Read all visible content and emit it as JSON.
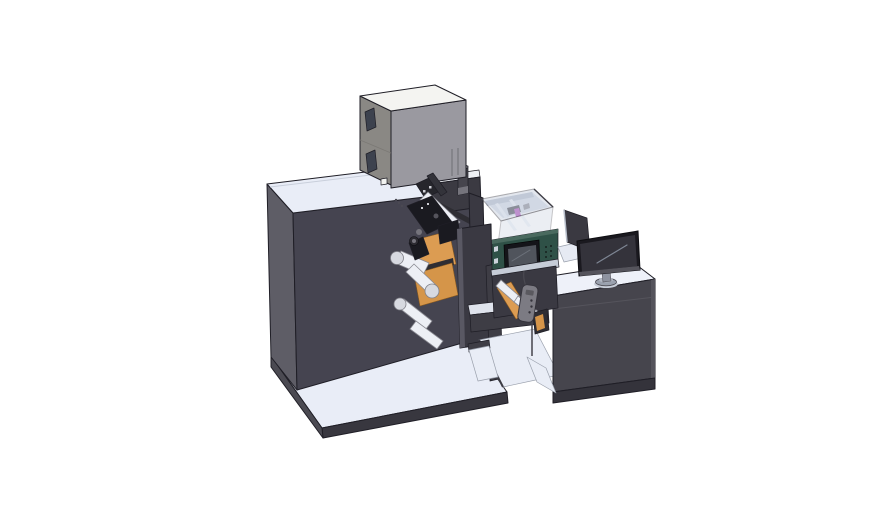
{
  "scene": {
    "type": "3d-cad-render",
    "subject": "label-printing-machine-assembly",
    "parts": [
      "base-platform",
      "main-cabinet",
      "electrical-box",
      "signal-cylinder",
      "unwind-rollers",
      "material-rolls",
      "die-mechanism",
      "front-plate",
      "printer-module",
      "transparent-cover",
      "print-carriage",
      "hmi-display",
      "green-control-panel",
      "pendant-remote",
      "support-beam",
      "support-column",
      "floor-wedges",
      "control-desk",
      "desk-monitor",
      "rear-panel",
      "monitor-stand"
    ]
  },
  "colors": {
    "background": "#ffffff",
    "cabinet_front": "#454450",
    "cabinet_side": "#5e5d66",
    "cabinet_top": "#e9edf7",
    "base_front": "#38373f",
    "base_side": "#4b4a52",
    "base_top": "#e9edf7",
    "box_front": "#9a99a0",
    "box_side": "#8a8884",
    "box_top": "#f4f4f1",
    "box_window": "#3d424e",
    "box_sq": "#f2f3f0",
    "riser_front": "#3b3a42",
    "riser_top": "#eef0f5",
    "stack_cylinder": "#46454d",
    "cyl_cap": "#8e8d95",
    "roller": "#edeff5",
    "roller_cap": "#d7d9e0",
    "roll_orange": "#dc9c52",
    "roll_orange2": "#d59549",
    "mech_black": "#1a1a20",
    "mech_dark": "#26262c",
    "mech_mid": "#33333a",
    "mech_gray": "#75747c",
    "rail_dark": "#2e2d33",
    "steel": "#55545c",
    "speck": "#cfd0d6",
    "plate_dark": "#3a3942",
    "plate_edge": "#595863",
    "printer_wall": "#3a3942",
    "cover_glass": "#c8d1df",
    "cover_interior": "#dbe1eb",
    "cover_backwall": "#bac2d0",
    "batten": "#f0f3f8",
    "magenta_part": "#b551bd",
    "inner_block": "#4c4b53",
    "green_panel": "#2f5147",
    "green_panel_edge": "#4a6a5f",
    "vent_dot": "#17231f",
    "hmi_frame": "#141419",
    "hmi_screen": "#50545c",
    "btn_light": "#ccd2db",
    "flange": "#c6ccd7",
    "pendant": "#7c7b83",
    "beam_top": "#dfe3ec",
    "frame_dark": "#3e3d45",
    "wedge": "#e9edf6",
    "desk_front": "#46454d",
    "desk_top": "#eef1f9",
    "desk_skirt": "#34333b",
    "shelf": "#e6eaf3",
    "panel_back": "#3a3941",
    "monitor_bezel": "#1a191f",
    "monitor_screen": "#34333b",
    "monitor_stand": "#8e93a0",
    "monitor_base": "#9aa1ae",
    "base_cap": "#b4bac6",
    "pad_shadow": "#c9cfda"
  }
}
